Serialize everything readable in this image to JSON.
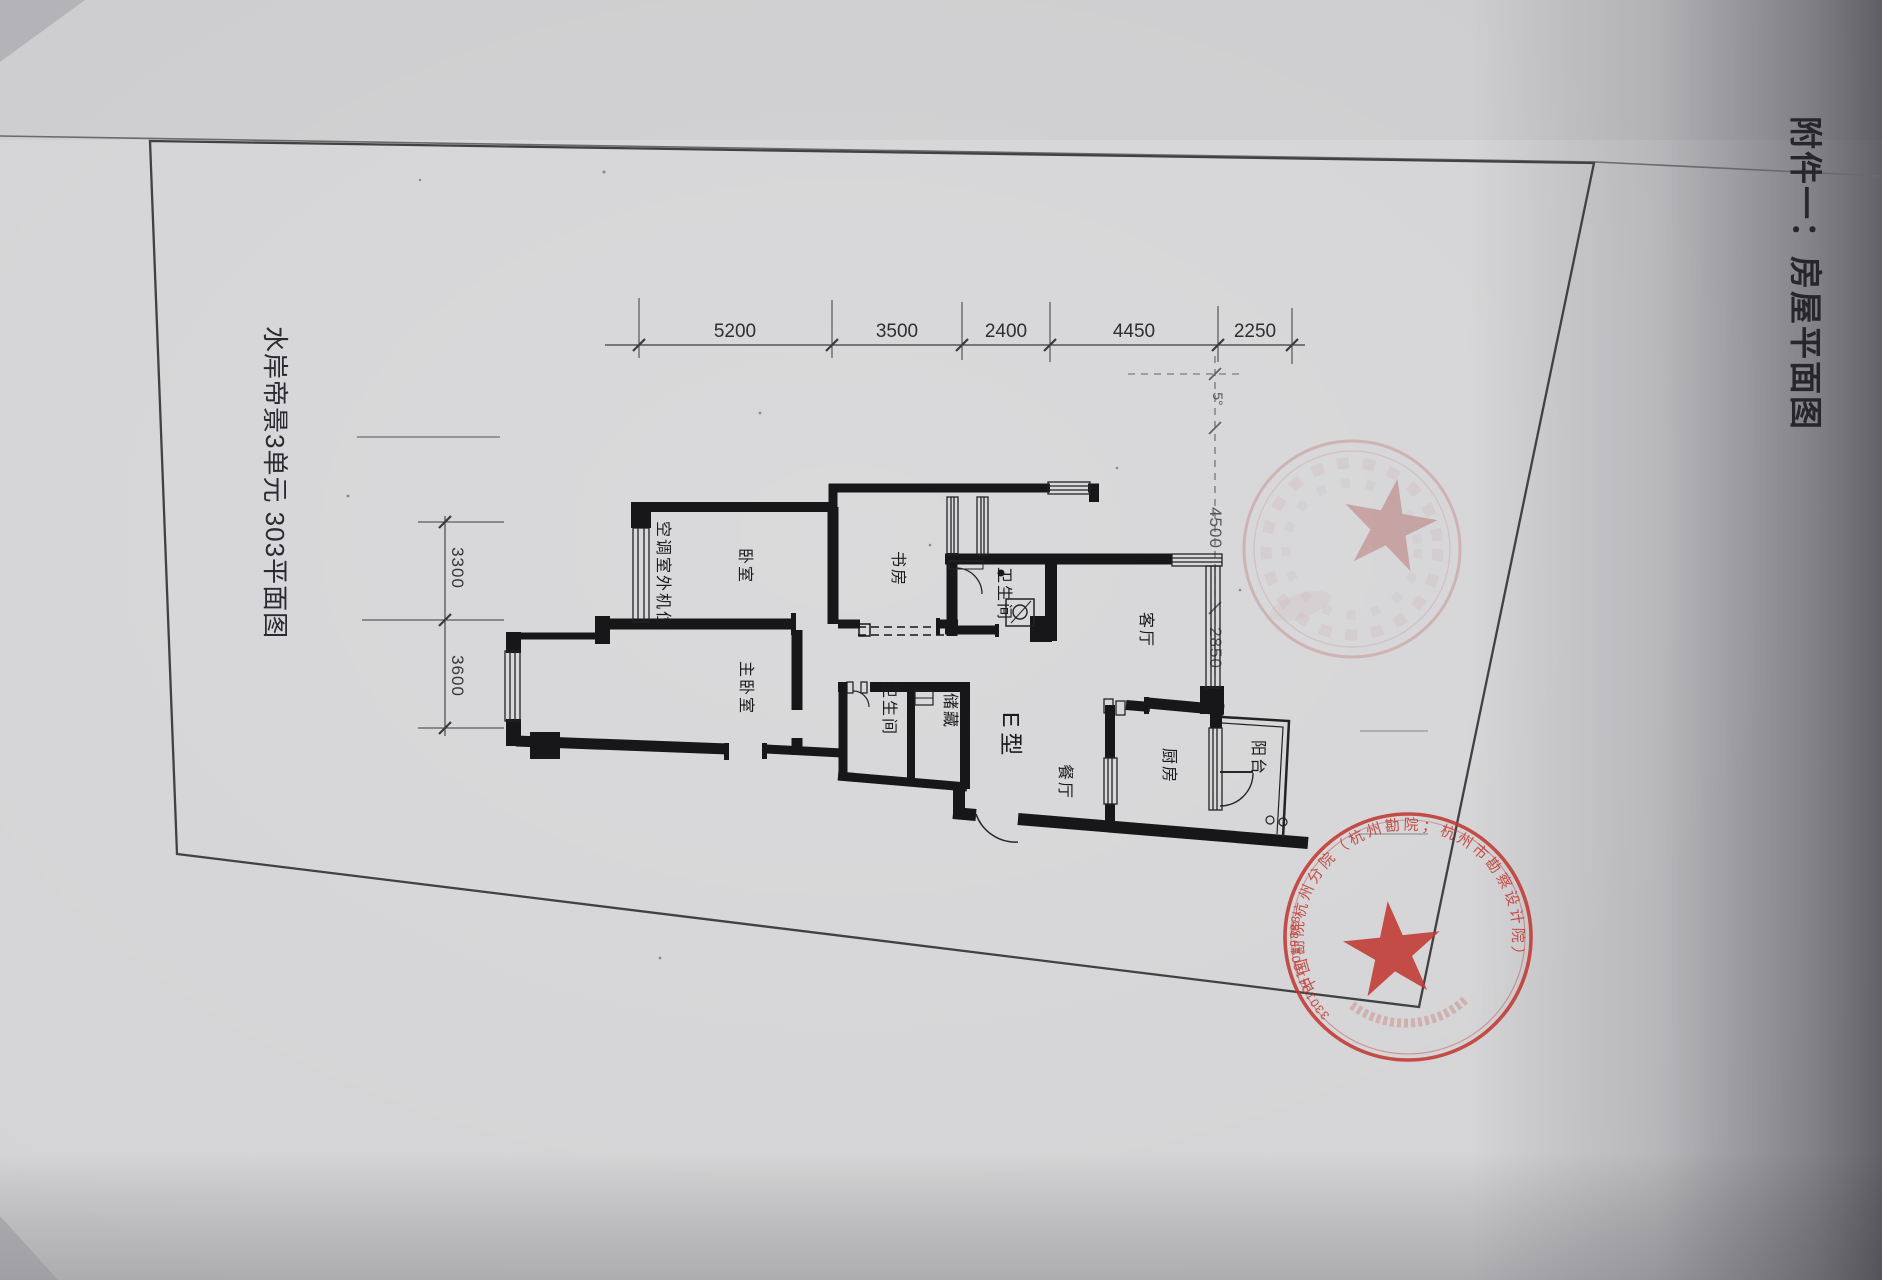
{
  "page": {
    "attachment_title": "附件一：房屋平面图",
    "plan_title": "水岸帝景3单元 303平面图",
    "unit_type": "E型"
  },
  "rooms": {
    "ac_unit": "空调室外机位",
    "bedroom": "卧室",
    "study": "书房",
    "bathroom1": "卫生间",
    "living_room": "客厅",
    "master_bedroom": "主卧室",
    "bathroom2": "卫生间",
    "storage": "储藏",
    "dining_room": "餐厅",
    "kitchen": "厨房",
    "balcony": "阳台"
  },
  "dimensions": {
    "top": [
      "5200",
      "3500",
      "2400",
      "4450",
      "2250"
    ],
    "left": [
      "3300",
      "3600"
    ],
    "right": [
      "5°",
      "4500",
      "2850"
    ]
  },
  "stamps": {
    "faint": {
      "style": "faint red circular seal with five-pointed star",
      "legible": false
    },
    "main": {
      "ring_text": "中国勘院杭州分院（杭州勘院；杭州市勘察设计院）",
      "number": "33010410019888",
      "star": true
    }
  },
  "colors": {
    "paper": "#d4d4d6",
    "ink": "#1a1a1c",
    "stamp_red": "#c13a33"
  }
}
